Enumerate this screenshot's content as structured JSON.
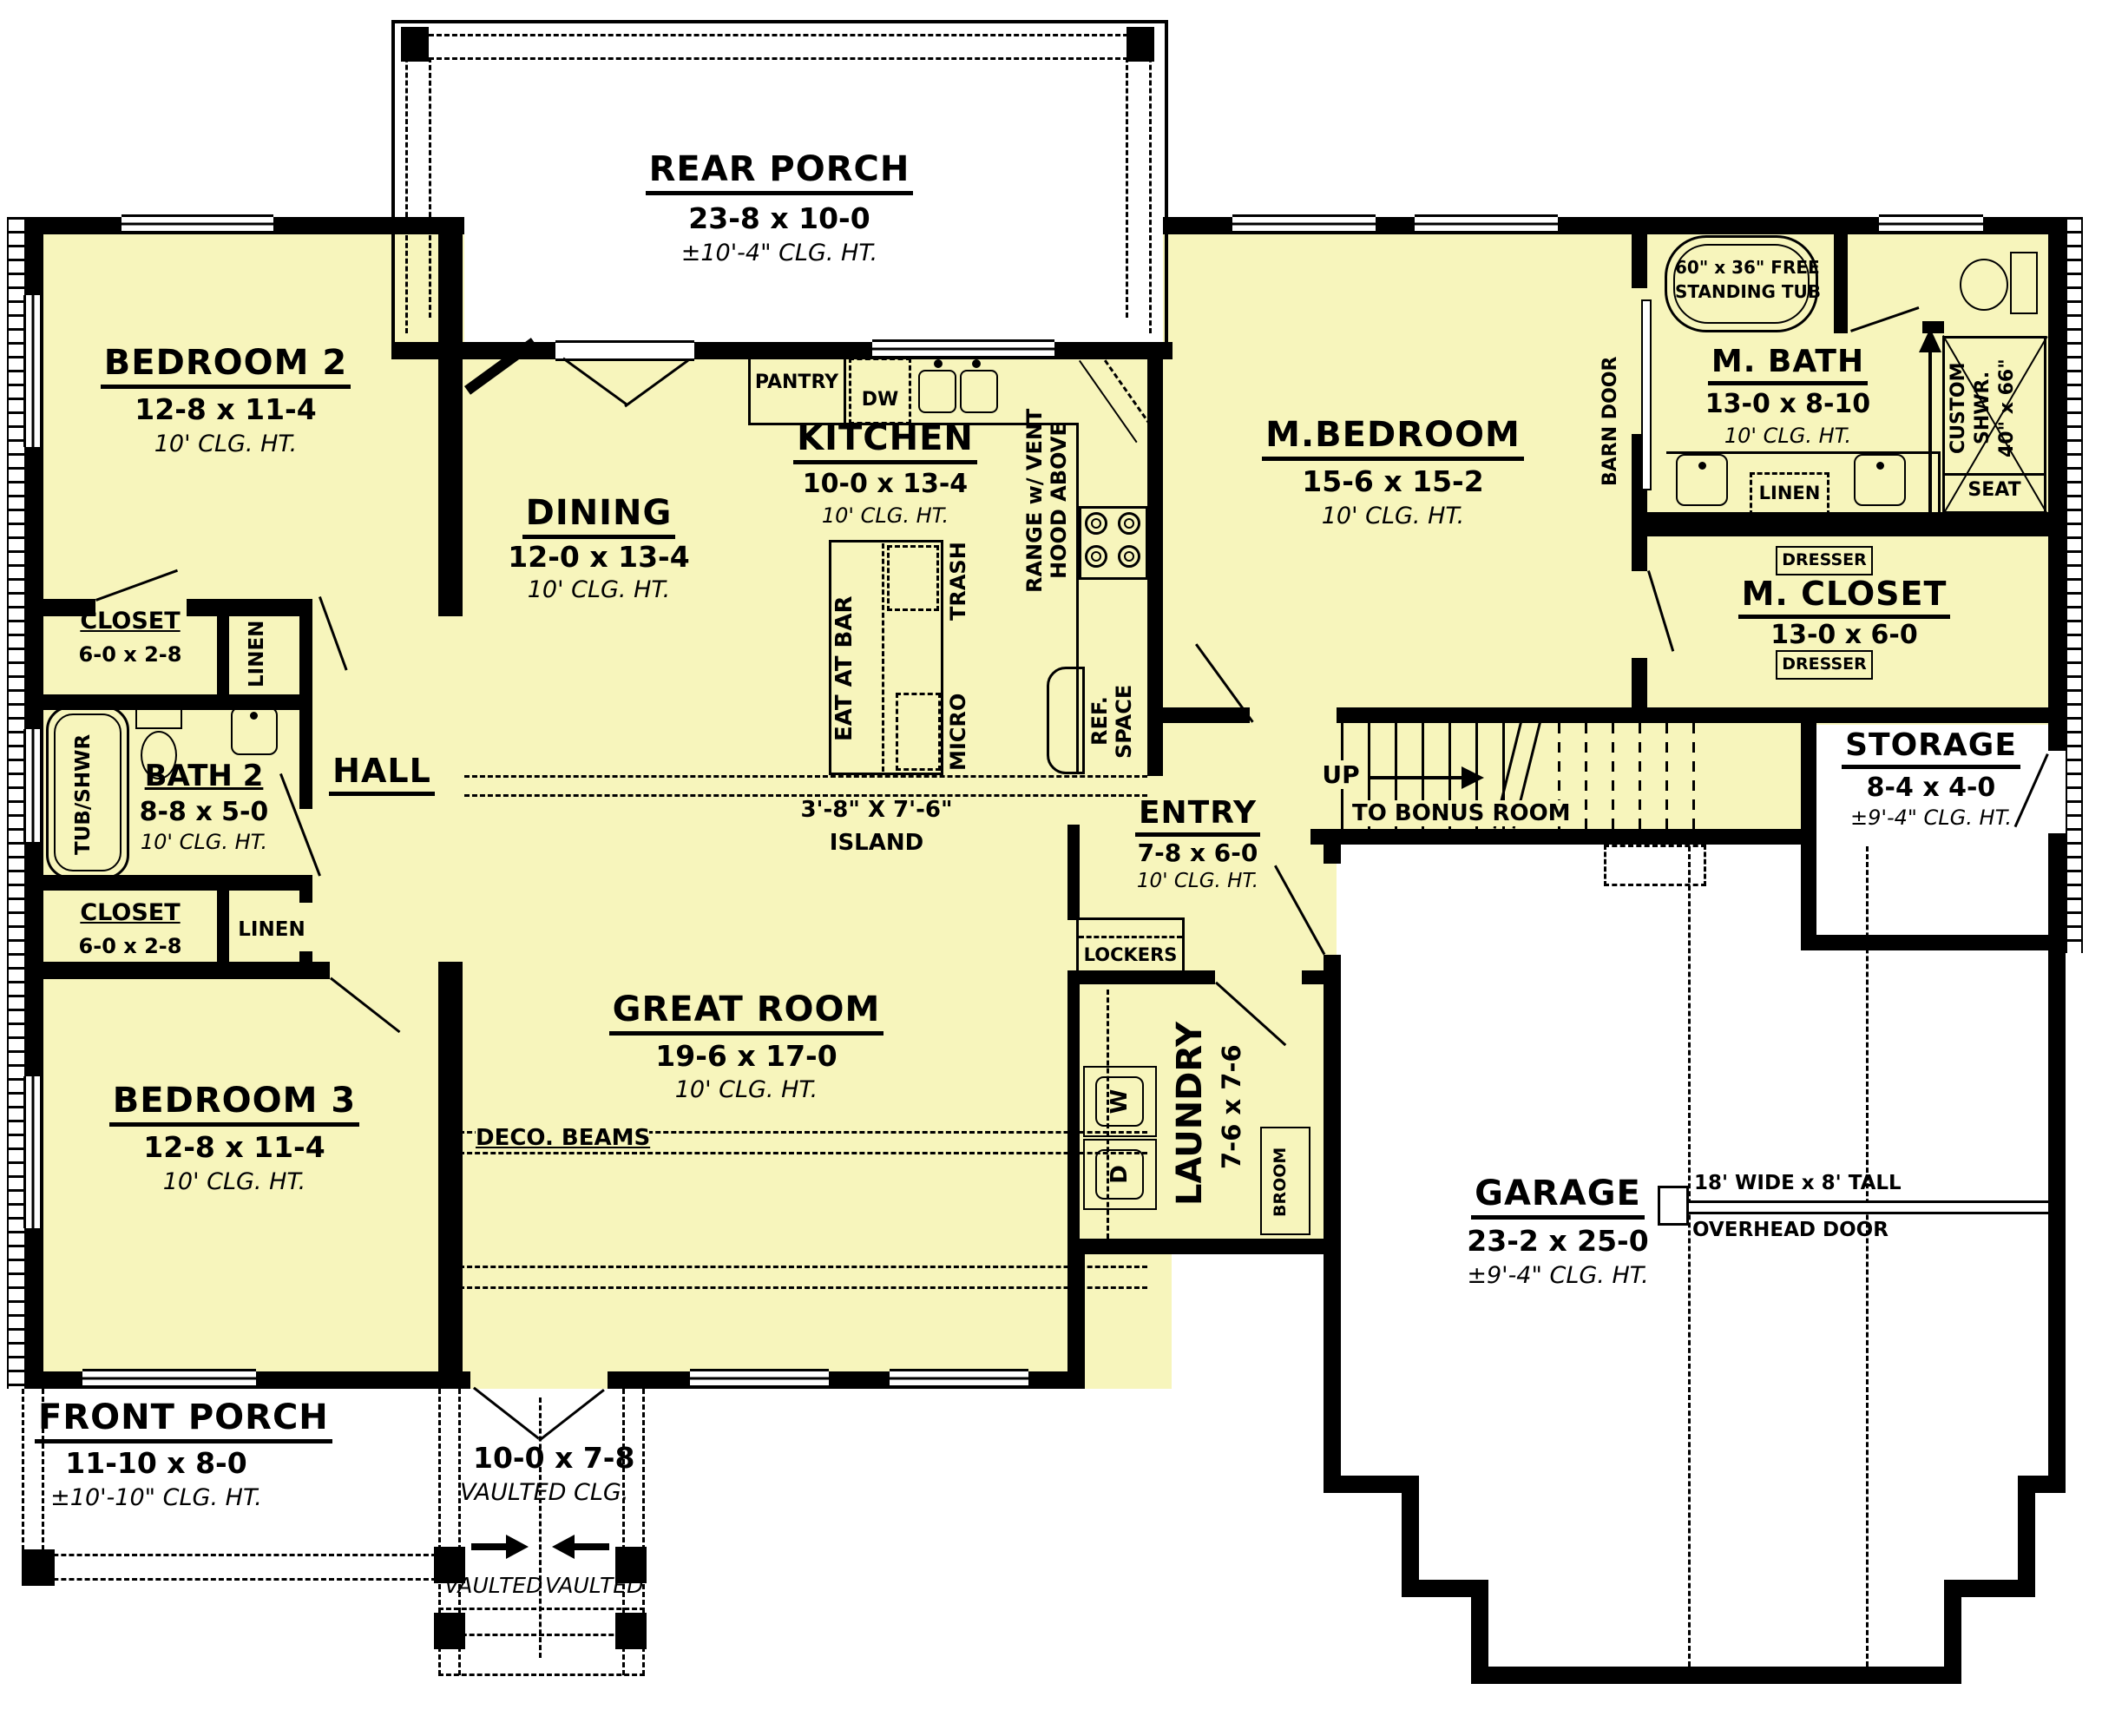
{
  "colors": {
    "floor": "#F7F5BC",
    "wall": "#000000"
  },
  "rooms": {
    "rear_porch": {
      "name": "REAR PORCH",
      "dims": "23-8 x 10-0",
      "clg": "±10'-4\" CLG. HT."
    },
    "bedroom2": {
      "name": "BEDROOM 2",
      "dims": "12-8 x 11-4",
      "clg": "10' CLG. HT."
    },
    "closet1": {
      "name": "CLOSET",
      "dims": "6-0 x 2-8"
    },
    "linen1": {
      "name": "LINEN"
    },
    "bath2": {
      "name": "BATH 2",
      "dims": "8-8 x 5-0",
      "clg": "10' CLG. HT.",
      "tub": "TUB/SHWR"
    },
    "hall": {
      "name": "HALL"
    },
    "closet2": {
      "name": "CLOSET",
      "dims": "6-0 x 2-8"
    },
    "linen2": {
      "name": "LINEN"
    },
    "bedroom3": {
      "name": "BEDROOM 3",
      "dims": "12-8 x 11-4",
      "clg": "10' CLG. HT."
    },
    "dining": {
      "name": "DINING",
      "dims": "12-0 x 13-4",
      "clg": "10' CLG. HT."
    },
    "kitchen": {
      "name": "KITCHEN",
      "dims": "10-0 x 13-4",
      "clg": "10' CLG. HT.",
      "pantry": "PANTRY",
      "dw": "DW",
      "trash": "TRASH",
      "eat_at_bar": "EAT AT BAR",
      "micro": "MICRO",
      "island_dims": "3'-8\" X 7'-6\"",
      "island": "ISLAND",
      "range1": "RANGE w/ VENT",
      "range2": "HOOD ABOVE",
      "ref1": "REF.",
      "ref2": "SPACE"
    },
    "great_room": {
      "name": "GREAT ROOM",
      "dims": "19-6 x 17-0",
      "clg": "10' CLG. HT.",
      "beams": "DECO. BEAMS"
    },
    "mbedroom": {
      "name": "M.BEDROOM",
      "dims": "15-6 x 15-2",
      "clg": "10' CLG. HT.",
      "barn": "BARN DOOR"
    },
    "mbath": {
      "name": "M. BATH",
      "dims": "13-0 x 8-10",
      "clg": "10' CLG. HT.",
      "tub1": "60\" x 36\" FREE",
      "tub2": "STANDING TUB",
      "shwr1": "CUSTOM",
      "shwr2": "SHWR.",
      "shwr3": "40\" x 66\"",
      "seat": "SEAT",
      "linen": "LINEN"
    },
    "mcloset": {
      "name": "M. CLOSET",
      "dims": "13-0 x 6-0",
      "dresser": "DRESSER"
    },
    "storage": {
      "name": "STORAGE",
      "dims": "8-4 x 4-0",
      "clg": "±9'-4\" CLG. HT."
    },
    "stairs": {
      "up": "UP",
      "dest": "TO BONUS ROOM"
    },
    "entry": {
      "name": "ENTRY",
      "dims": "7-8 x 6-0",
      "clg": "10' CLG. HT.",
      "lockers": "LOCKERS"
    },
    "laundry": {
      "name": "LAUNDRY",
      "dims": "7-6 x 7-6",
      "w": "W",
      "d": "D",
      "broom": "BROOM"
    },
    "garage": {
      "name": "GARAGE",
      "dims": "23-2 x 25-0",
      "clg": "±9'-4\" CLG. HT.",
      "door1": "18' WIDE x 8' TALL",
      "door2": "OVERHEAD DOOR"
    },
    "front_porch": {
      "name": "FRONT PORCH",
      "dims": "11-10 x 8-0",
      "clg": "±10'-10\" CLG. HT."
    },
    "vaulted_entry": {
      "dims": "10-0 x 7-8",
      "clg": "VAULTED CLG.",
      "vaulted": "VAULTED"
    }
  }
}
